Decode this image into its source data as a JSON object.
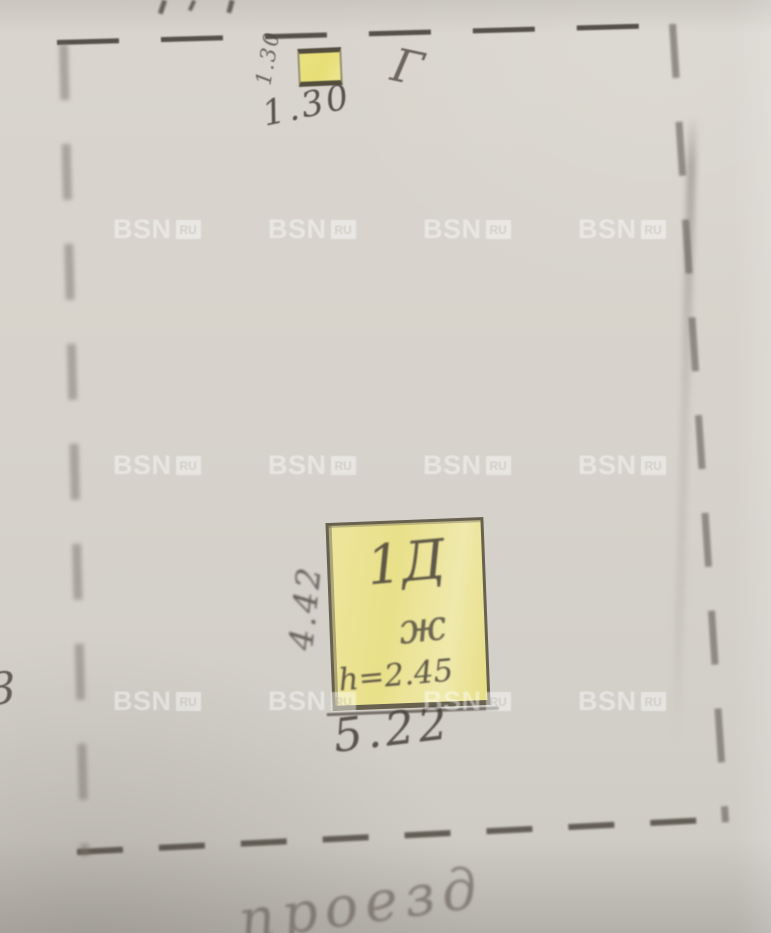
{
  "watermark": {
    "text": "BSN",
    "suffix": "RU"
  },
  "plan": {
    "top_structure": {
      "width_label": "1.30",
      "side_label": "1.30",
      "letter_mark": "Г"
    },
    "main_structure": {
      "label": "1Д",
      "sublabel": "ж",
      "height_note": "h=2.45",
      "width_label": "5.22",
      "depth_label": "4.42"
    },
    "bottom_caption": "проезд",
    "left_edge_mark": "3"
  },
  "colors": {
    "paper": "#d6d2cb",
    "structure_fill": "#ebe28c",
    "pencil": "#48423a",
    "watermark": "#ffffff"
  }
}
